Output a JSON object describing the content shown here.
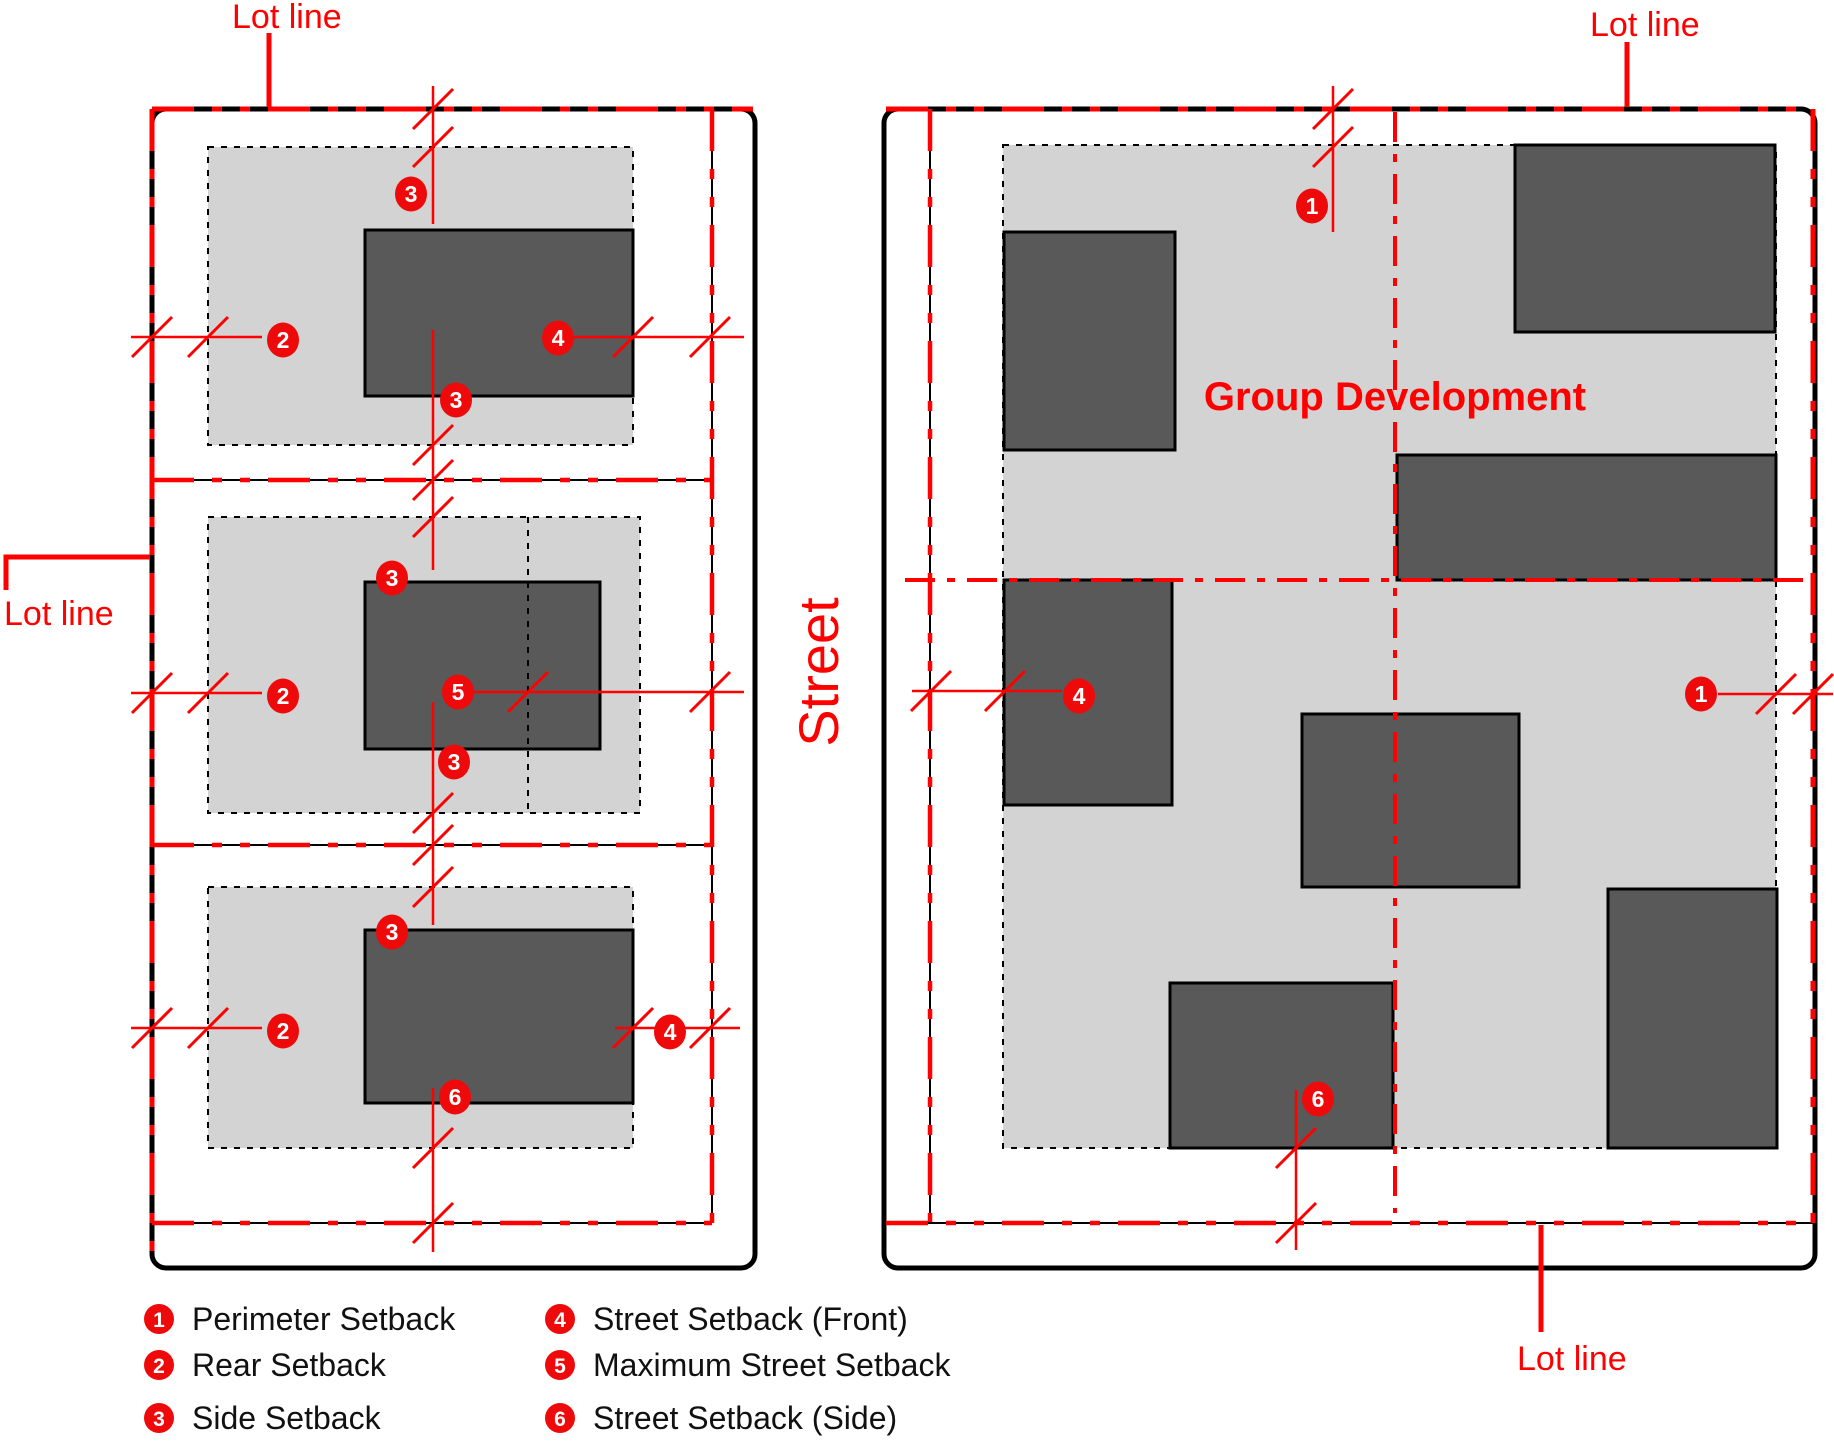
{
  "labels": {
    "lot_line": "Lot line",
    "street": "Street",
    "group_development": "Group Development"
  },
  "legend": [
    {
      "num": "1",
      "label": "Perimeter Setback"
    },
    {
      "num": "2",
      "label": "Rear Setback"
    },
    {
      "num": "3",
      "label": "Side Setback"
    },
    {
      "num": "4",
      "label": "Street Setback (Front)"
    },
    {
      "num": "5",
      "label": "Maximum Street Setback"
    },
    {
      "num": "6",
      "label": "Street Setback (Side)"
    }
  ],
  "markers_on_diagram": {
    "left_block_lot1": [
      "3",
      "2",
      "4",
      "3"
    ],
    "left_block_lot2": [
      "3",
      "2",
      "5",
      "3"
    ],
    "left_block_lot3": [
      "3",
      "2",
      "4",
      "6"
    ],
    "right_block": [
      "1",
      "4",
      "1",
      "6"
    ]
  },
  "colors": {
    "red": "#ff0000",
    "setback_area_gray": "#d3d3d3",
    "building_gray": "#595959",
    "line_black": "#000000"
  }
}
